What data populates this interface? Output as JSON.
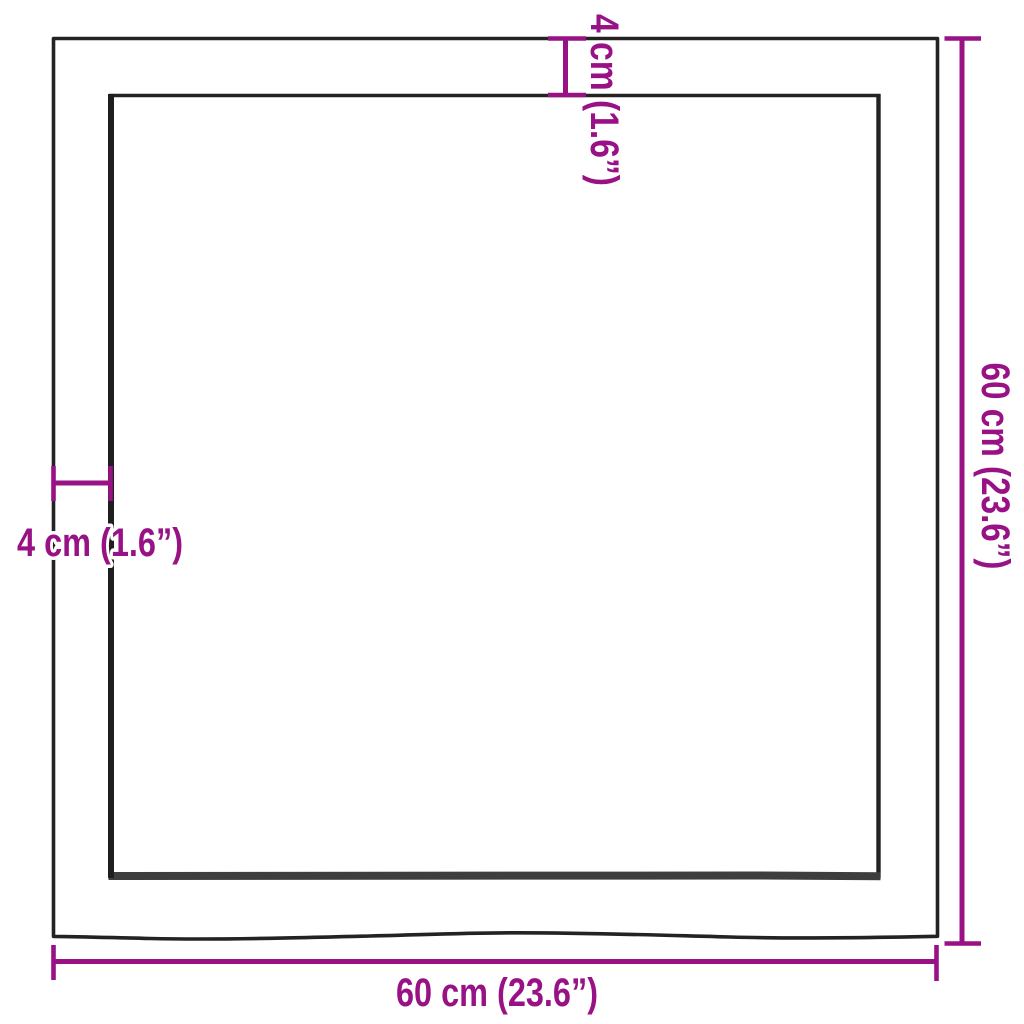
{
  "labels": {
    "width": "60 cm (23.6”)",
    "height": "60 cm (23.6”)",
    "edge_thickness_top": "4 cm (1.6”)",
    "edge_thickness_left": "4 cm (1.6”)"
  },
  "colors": {
    "dimension": "#981286",
    "outline": "#232323",
    "outline_dark": "#1e1e1e",
    "inner_shadow": "#3e3e3e",
    "background": "#ffffff"
  }
}
